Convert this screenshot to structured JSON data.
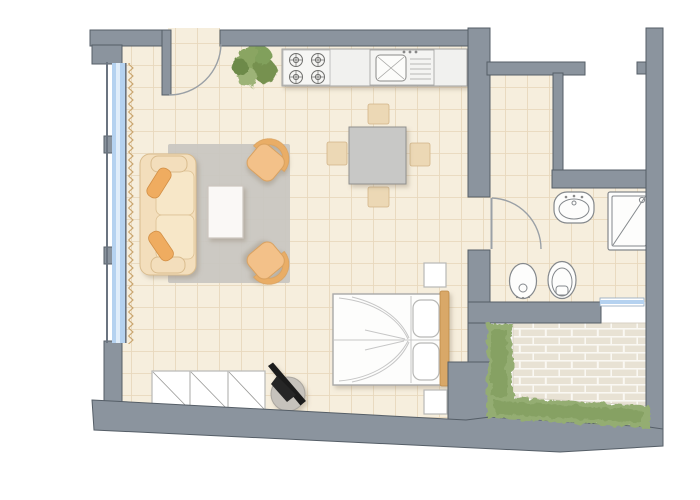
{
  "document": {
    "type": "architectural-floor-plan",
    "view": "top-down",
    "background": "#ffffff",
    "text_labels": []
  },
  "colors": {
    "wall": "#8b949e",
    "wallEdge": "#555e67",
    "floor": "#f6eedd",
    "tileLine": "#dcc7a2",
    "window": "#b5d2f0",
    "rug": "#c9c6c1",
    "sofa": "#f3debc",
    "pillow": "#efac60",
    "armchair": "#f3c189",
    "diningTable": "#c8c8c6",
    "diningChair": "#ecd8b5",
    "counter": "#f1f1ef",
    "fixture": "#fdfdfc",
    "fixtureLine": "#84888c",
    "headboard": "#d9a868",
    "brick": "#e8e2d4",
    "mortar": "#faf8f3",
    "hedge": "#94ad72",
    "hedgeDark": "#7d9a5b",
    "plant": "#8aa562",
    "doorArc": "#9aa0a6",
    "blackObject": "#1c1c1c"
  },
  "plan": {
    "rooms": [
      {
        "name": "living-dining-sleeping-area",
        "furniture": [
          "sofa",
          "sofa-pillows",
          "rug",
          "coffee-table",
          "armchair-upper",
          "armchair-lower",
          "dining-table",
          "dining-chairs",
          "double-bed",
          "bed-pillows",
          "headboard",
          "nightstand-upper",
          "nightstand-lower",
          "wardrobe",
          "stool-with-black-object",
          "potted-plant"
        ]
      },
      {
        "name": "kitchen-strip",
        "furniture": [
          "counter",
          "stove-4-burners",
          "sink-with-drainboard"
        ]
      },
      {
        "name": "bathroom",
        "furniture": [
          "washbasin",
          "shower",
          "bidet",
          "toilet"
        ]
      },
      {
        "name": "terrace",
        "furniture": [
          "brick-paving",
          "hedge-left",
          "hedge-bottom"
        ]
      },
      {
        "name": "lightwell-void",
        "furniture": []
      }
    ],
    "openings": [
      "entrance-door-with-swing",
      "bathroom-door-with-swing",
      "window-band-left-with-curtain",
      "terrace-window"
    ]
  }
}
